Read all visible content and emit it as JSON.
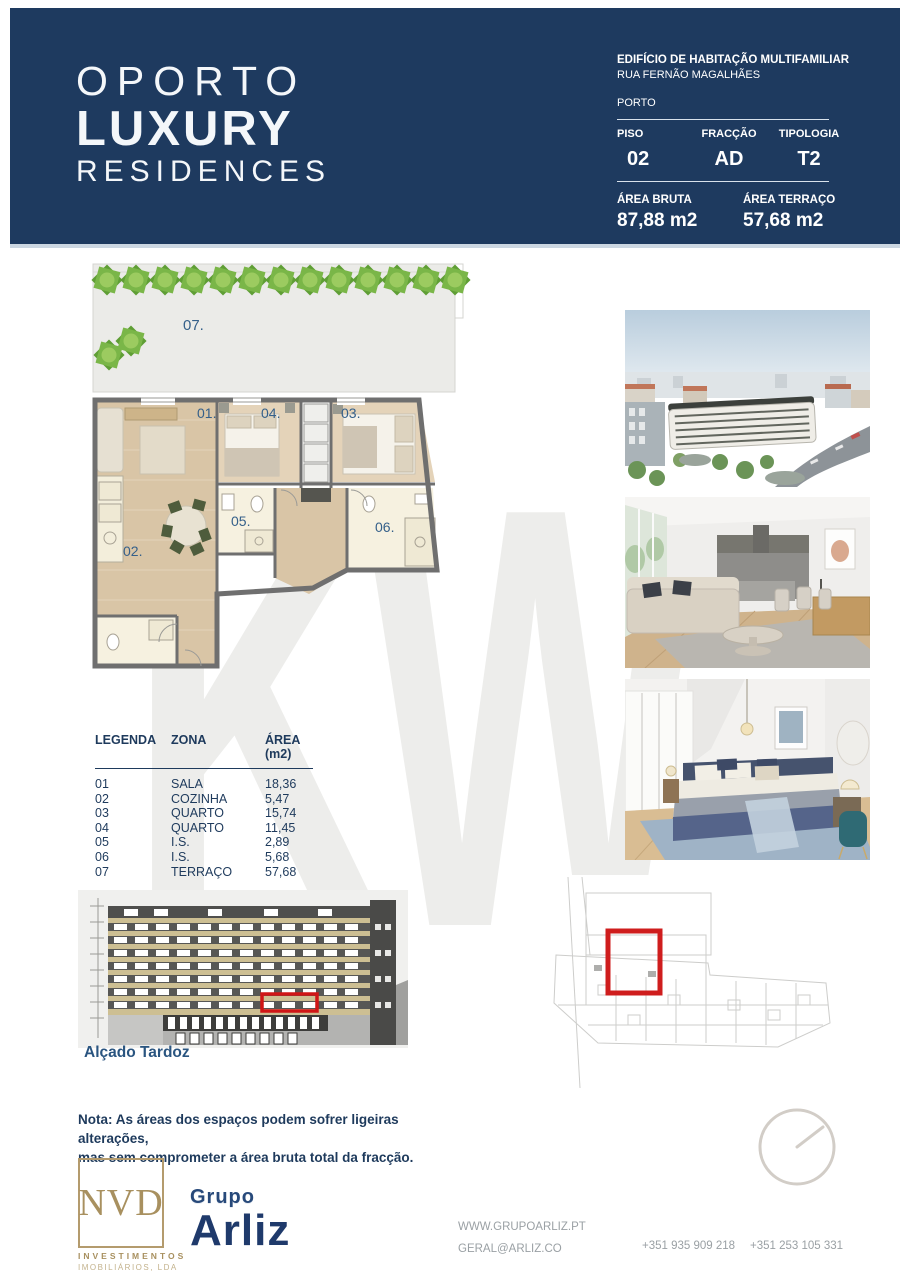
{
  "page": {
    "watermark": "KW"
  },
  "header": {
    "logo": {
      "line1": "OPORTO",
      "line2": "LUXURY",
      "line3": "RESIDENCES"
    },
    "building": "EDIFÍCIO DE HABITAÇÃO MULTIFAMILIAR",
    "street": "RUA FERNÃO MAGALHÃES",
    "city": "PORTO",
    "specs": {
      "piso_label": "PISO",
      "piso": "02",
      "fraccao_label": "FRACÇÃO",
      "fraccao": "AD",
      "tipologia_label": "TIPOLOGIA",
      "tipologia": "T2",
      "area_bruta_label": "ÁREA BRUTA",
      "area_bruta": "87,88 m2",
      "area_terraco_label": "ÁREA TERRAÇO",
      "area_terraco": "57,68 m2"
    }
  },
  "floor_plan": {
    "labels": {
      "terrace": "07.",
      "living": "01.",
      "kitchen": "02.",
      "bedroom1": "03.",
      "bedroom2": "04.",
      "bath1": "05.",
      "bath2": "06."
    }
  },
  "legend": {
    "headers": [
      "LEGENDA",
      "ZONA",
      "ÁREA (m2)"
    ],
    "rows": [
      [
        "01",
        "SALA",
        "18,36"
      ],
      [
        "02",
        "COZINHA",
        "5,47"
      ],
      [
        "03",
        "QUARTO",
        "15,74"
      ],
      [
        "04",
        "QUARTO",
        "11,45"
      ],
      [
        "05",
        "I.S.",
        "2,89"
      ],
      [
        "06",
        "I.S.",
        "5,68"
      ],
      [
        "07",
        "TERRAÇO",
        "57,68"
      ]
    ]
  },
  "elevation": {
    "caption": "Alçado Tardoz"
  },
  "note": {
    "line1": "Nota: As áreas dos espaços podem sofrer ligeiras alterações,",
    "line2": "mas sem comprometer a área bruta total da fracção."
  },
  "footer": {
    "nvd": {
      "name": "NVD",
      "line1": "INVESTIMENTOS",
      "line2": "IMOBILIÁRIOS, LDA"
    },
    "arliz": {
      "grupo": "Grupo",
      "name": "Arliz"
    },
    "contacts": {
      "website": "WWW.GRUPOARLIZ.PT",
      "email": "GERAL@ARLIZ.CO",
      "phone1": "+351 935 909 218",
      "phone2": "+351 253 105 331"
    }
  },
  "colors": {
    "navy": "#1e3a5f",
    "red": "#cc1f1f",
    "tan": "#ab9468",
    "green": "#7ab648"
  }
}
